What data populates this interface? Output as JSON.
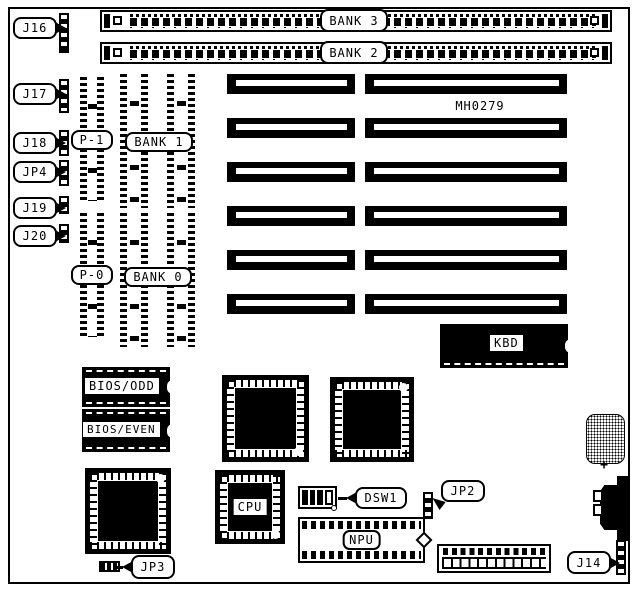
{
  "diagram": {
    "ink_color": "#000000",
    "paper_color": "#ffffff"
  },
  "board": {
    "part_number": "MH0279",
    "battery_polarity": "+"
  },
  "memory": {
    "simm_banks": [
      {
        "label": "BANK 3"
      },
      {
        "label": "BANK 2"
      }
    ],
    "dip_banks": [
      {
        "label": "BANK 1"
      },
      {
        "label": "BANK 0"
      }
    ],
    "parity_columns": [
      {
        "label": "P-1"
      },
      {
        "label": "P-0"
      }
    ]
  },
  "jumpers": {
    "left_column": [
      {
        "label": "J16"
      },
      {
        "label": "J17"
      },
      {
        "label": "J18"
      },
      {
        "label": "JP4"
      },
      {
        "label": "J19"
      },
      {
        "label": "J20"
      }
    ],
    "jp2": {
      "label": "JP2"
    },
    "jp3": {
      "label": "JP3"
    },
    "j14": {
      "label": "J14"
    }
  },
  "switches": {
    "dsw1": {
      "label": "DSW1"
    }
  },
  "chips": {
    "kbd": {
      "label": "KBD"
    },
    "cpu": {
      "label": "CPU"
    },
    "npu": {
      "label": "NPU"
    },
    "bios_odd": {
      "label": "BIOS/ODD"
    },
    "bios_even": {
      "label": "BIOS/EVEN"
    }
  }
}
